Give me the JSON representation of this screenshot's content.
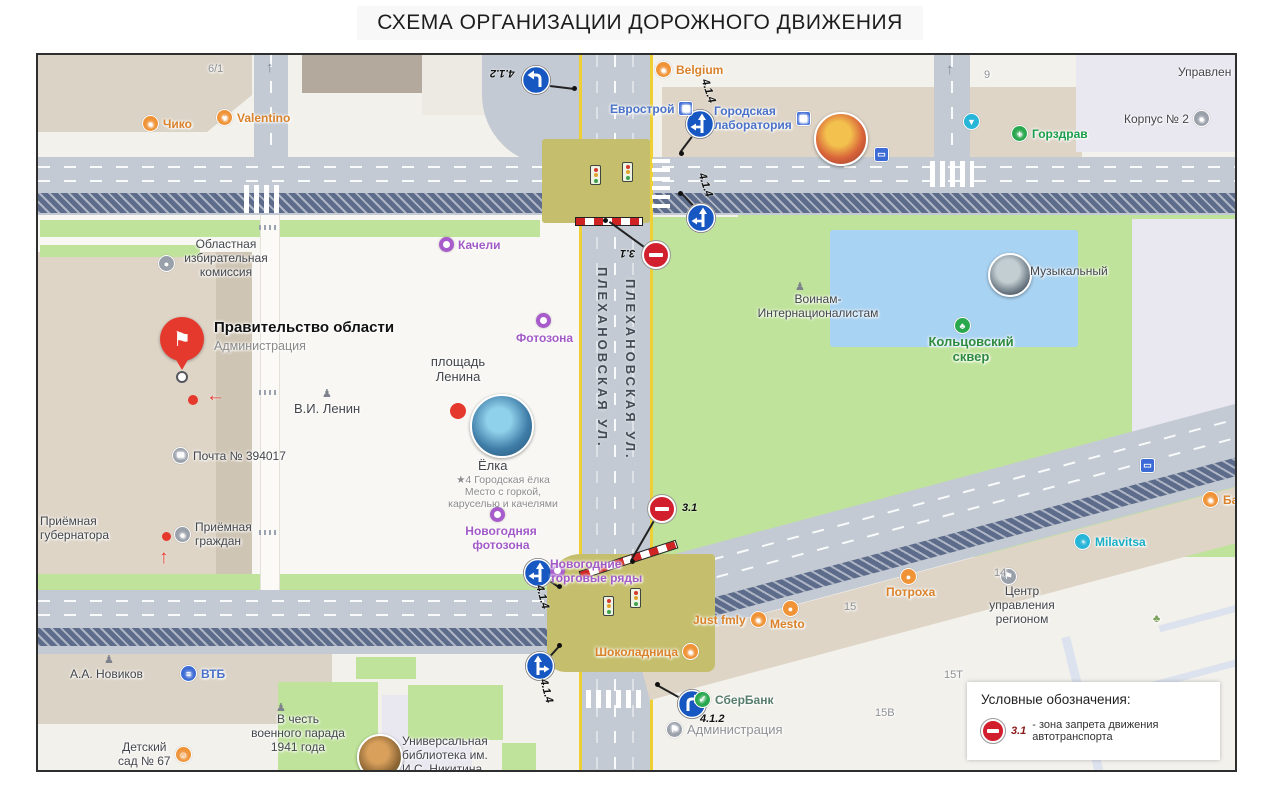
{
  "title": "СХЕМА  ОРГАНИЗАЦИИ ДОРОЖНОГО ДВИЖЕНИЯ",
  "streets": {
    "plekhanovskaya_a": "ПЛЕХАНОВСКАЯ УЛ.",
    "plekhanovskaya_b": "ПЛЕХАНОВСКАЯ УЛ."
  },
  "signs": {
    "s1": "4.1.2",
    "s2": "4.1.4",
    "s3": "4.1.4",
    "s4": "3.1",
    "s5": "3.1",
    "s6": "4.1.4",
    "s7": "4.1.4",
    "s8": "4.1.2"
  },
  "icons": {
    "flag": "⚑",
    "arrow_left": "←",
    "arrow_up": "↑",
    "up_lane": "↑",
    "cross": "+",
    "tree": "♣",
    "mail": "✉",
    "smile": "☺",
    "vtb": "≡",
    "check": "✓",
    "bus": "▭",
    "bullet": "●"
  },
  "pois": {
    "chiko": "Чико",
    "valentino": "Valentino",
    "bld_6_1": "6/1",
    "belgium": "Belgium",
    "evrostroy": "Еврострой",
    "gorlab": "Городская\nлаборатория",
    "bld_9": "9",
    "gorzdrav": "Горздрав",
    "korpus2": "Корпус № 2",
    "upravlen": "Управлен",
    "muzykalny": "Музыкальный",
    "voinam": "Воинам-\nИнтернационалистам",
    "koltsovsky": "Кольцовский\nсквер",
    "oblkom": "Областная\nизбирательная\nкомиссия",
    "pravitelstvo": "Правительство области",
    "pravitelstvo_sub": "Администрация",
    "pochta": "Почта № 394017",
    "priem_gub": "Приёмная\nгубернатора",
    "priem_grazhdan": "Приёмная\nграждан",
    "kacheli": "Качели",
    "fotozona": "Фотозона",
    "pl_lenina": "площадь\nЛенина",
    "lenin": "В.И. Ленин",
    "elka": "Ёлка",
    "elka_sub": "★4 Городская ёлка\nМесто с горкой,\nкаруселью и качелями",
    "novog_fotozona": "Новогодняя\nфотозона",
    "novog_torg": "Новогодние\nторговые ряды",
    "shokoladnitsa": "Шоколадница",
    "just_fmly": "Just fmly",
    "mesto": "Mesto",
    "sberbank": "СберБанк",
    "admin2": "Администрация",
    "novikov": "А.А. Новиков",
    "vtb": "ВТБ",
    "parad": "В честь\nвоенного парада\n1941 года",
    "detsad": "Детский\nсад № 67",
    "biblioteka": "Универсальная\nбиблиотека им.\nИ.С. Никитина",
    "potroha": "Потроха",
    "tsentr": "Центр\nуправления\nрегионом",
    "milavitsa": "Milavitsa",
    "bara": "Бара",
    "n14": "14",
    "n15": "15",
    "n15v": "15В",
    "n15t": "15Т"
  },
  "legend": {
    "heading": "Условные обозначения:",
    "sign": "3.1",
    "text": "- зона запрета движения автотранспорта"
  }
}
